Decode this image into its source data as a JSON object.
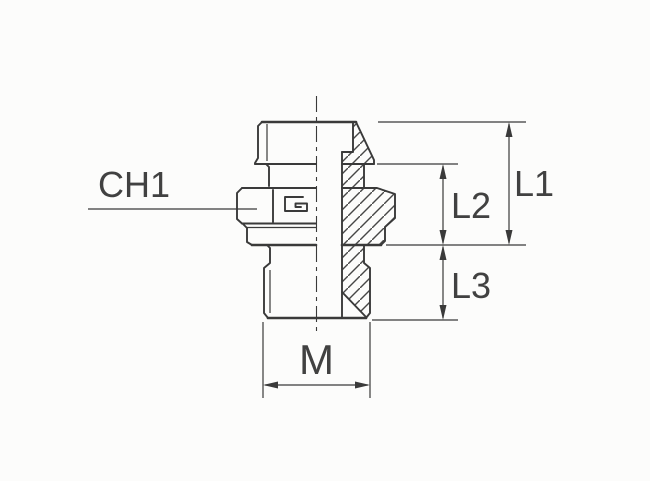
{
  "drawing": {
    "title": "fitting-cross-section",
    "labels": {
      "ch1": "CH1",
      "l1": "L1",
      "l2": "L2",
      "l3": "L3",
      "m": "M"
    },
    "colors": {
      "background": "#fcfcfb",
      "line": "#3a3a3a",
      "text": "#414141"
    }
  }
}
